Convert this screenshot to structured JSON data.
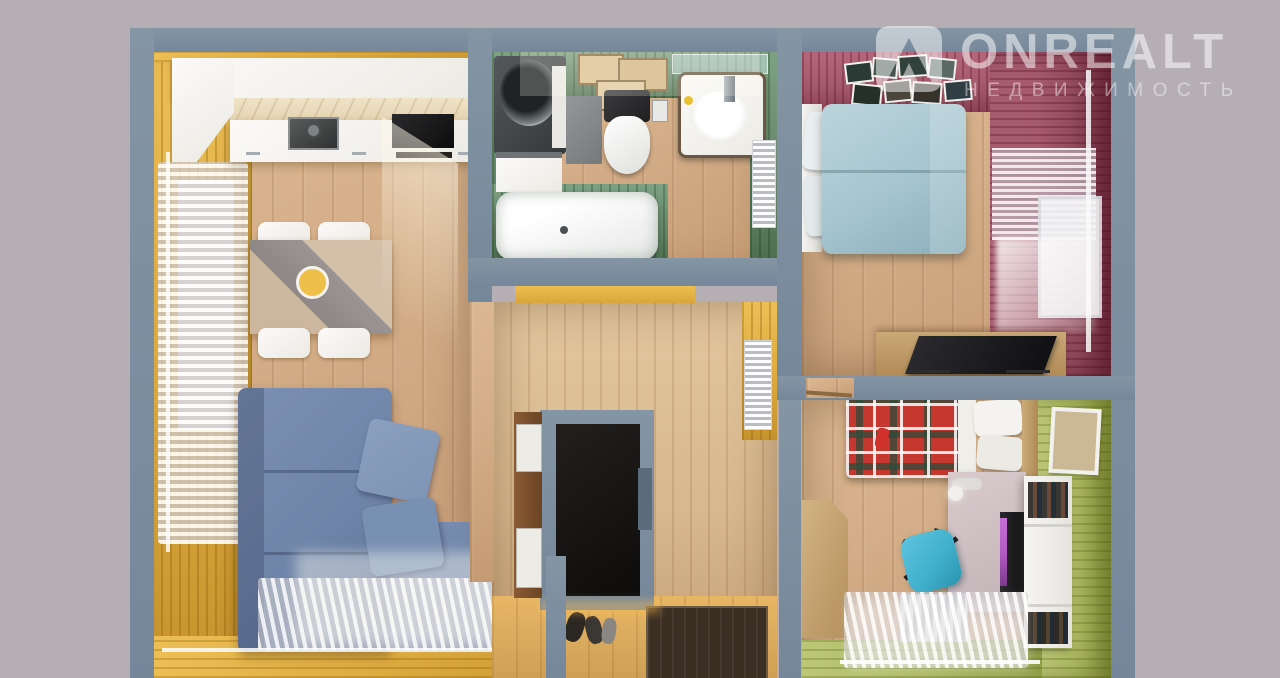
{
  "scene": {
    "type": "3d-floor-plan-top-down-render",
    "subject": "two-room apartment interior"
  },
  "watermark": {
    "brand": "ONREALT",
    "subtitle": "НЕДВИЖИМОСТЬ",
    "icon": "onrealt-house-peak-icon"
  },
  "colors": {
    "bg": "#b5afb5",
    "wall": "#8495a4",
    "wall_dark": "#75879a",
    "floor": "#d3ad87",
    "yellow_wall": "#ddaa3e",
    "green_wall": "#68886c",
    "pink_wall": "#a55a6c",
    "kid_green_wall": "#aab75f",
    "hall_wood": "#d8b88d",
    "sofa": "#6e84a8",
    "bed_teal": "#a7c6d0",
    "plaid_red": "#c5372f",
    "chair_teal": "#41b1cd",
    "screen_purple": "#b45ac5",
    "doormat": "#3b2f23",
    "dark_furniture": "#171513"
  },
  "rooms": [
    {
      "name": "living-room-kitchen",
      "wall_finish": "yellow wood paneling",
      "furniture": [
        "white-kitchen-counter",
        "sink",
        "black-cooktop",
        "dining-table",
        "four-white-chairs",
        "blue-corner-sofa",
        "two-pillows",
        "left-window-curtains",
        "bottom-window-curtains"
      ]
    },
    {
      "name": "bathroom",
      "wall_finish": "green paneling",
      "furniture": [
        "washing-machine",
        "honeycomb-wood-shelf",
        "wall-hung-toilet",
        "vanity-sink",
        "bathtub",
        "towel-radiator"
      ]
    },
    {
      "name": "hallway",
      "wall_finish": "light wood paneling",
      "furniture": [
        "built-in-dark-wardrobe",
        "shoe-cabinet",
        "shoes",
        "entry-doormat",
        "radiator"
      ]
    },
    {
      "name": "bedroom",
      "wall_finish": "berry-pink paneling",
      "furniture": [
        "double-bed-teal-blanket",
        "photo-gallery-wall",
        "right-window-curtains",
        "dresser-with-tv"
      ]
    },
    {
      "name": "kids-room",
      "wall_finish": "olive-green paneling",
      "furniture": [
        "single-bed-plaid-blanket",
        "corner-wardrobe",
        "desk-with-monitor",
        "teal-swivel-chair",
        "white-bookshelf",
        "window-radiator",
        "wall-picture"
      ]
    }
  ]
}
